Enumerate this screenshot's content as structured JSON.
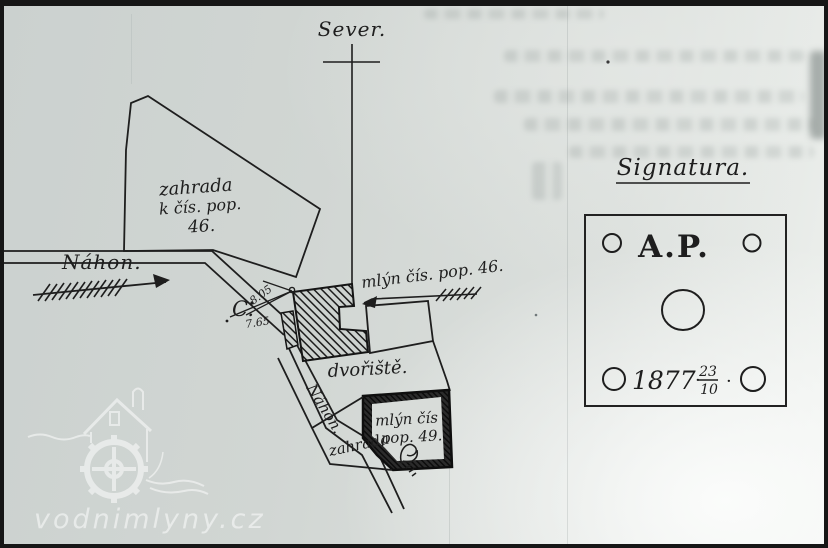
{
  "map": {
    "north_label": "Sever.",
    "garden46": {
      "line1": "zahrada",
      "line2": "k čís. pop.",
      "line3": "46."
    },
    "channel_label": "Náhon.",
    "channel_label_lower": "Náhon.",
    "mill46_label": "mlýn čís. pop. 46.",
    "courtyard_label": "dvořiště.",
    "mill49": {
      "line1": "mlýn čís",
      "line2": "pop. 49."
    },
    "garden49_label": "zahrada",
    "point_label": "C.",
    "measurements": {
      "upper": "8.05",
      "lower": "7.65"
    }
  },
  "legend": {
    "title": "Signatura.",
    "stamp_initials": "A.P.",
    "year": "1877",
    "separator_dot": "·",
    "date_fraction": {
      "numerator": "23",
      "denominator": "10"
    }
  },
  "watermark": {
    "site": "vodnimlyny.cz"
  },
  "colors": {
    "ink": "#1e1e1e",
    "paper": "#d3d8d5",
    "watermark": "#ffffff"
  }
}
